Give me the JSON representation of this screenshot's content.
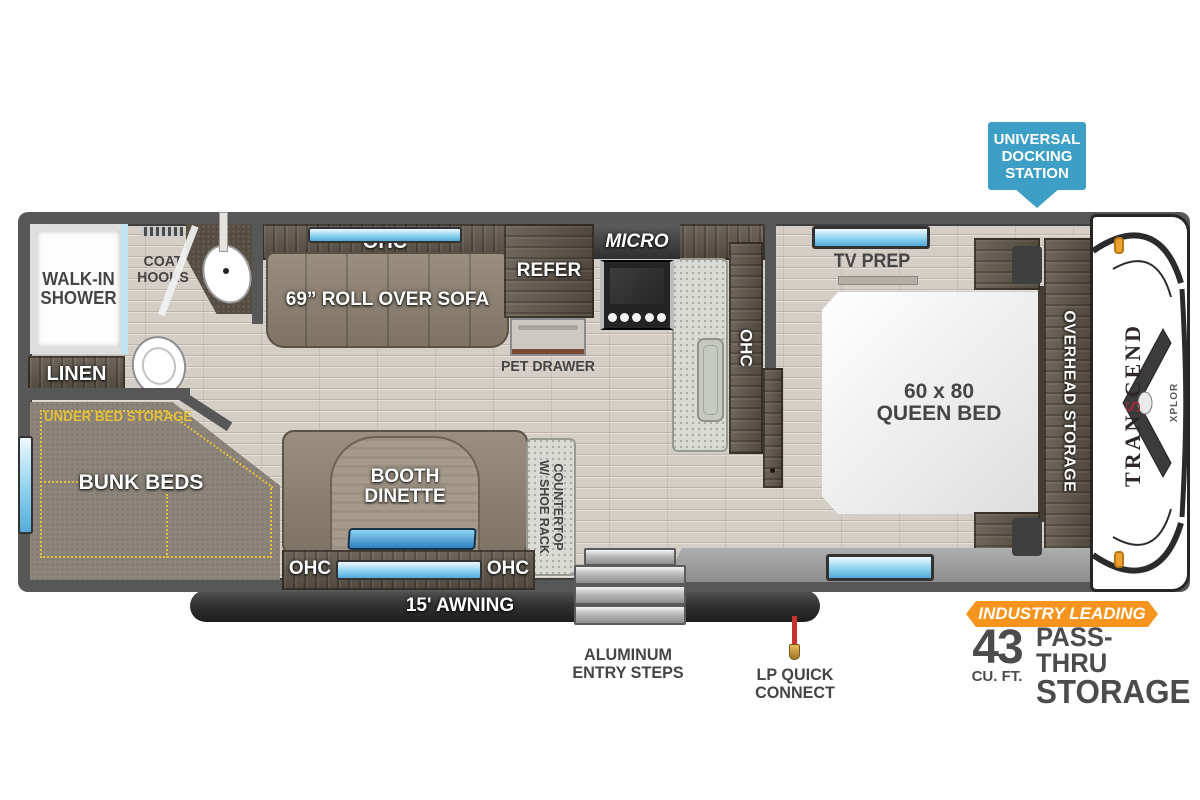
{
  "plan": {
    "labels": {
      "ohc": "OHC",
      "sofa": "69” ROLL OVER SOFA",
      "refer": "REFER",
      "micro": "MICRO",
      "pet_drawer": "PET DRAWER",
      "coat_1": "COAT",
      "coat_2": "HOOKS",
      "shower_1": "WALK-IN",
      "shower_2": "SHOWER",
      "linen": "LINEN",
      "under_bed_storage": "UNDER BED STORAGE",
      "bunk_beds": "BUNK BEDS",
      "dinette_1": "BOOTH",
      "dinette_2": "DINETTE",
      "countertop_1": "COUNTERTOP",
      "countertop_2": "W/ SHOE RACK",
      "tv_prep": "TV PREP",
      "bed_1": "60 x 80",
      "bed_2": "QUEEN BED",
      "overhead_storage": "OVERHEAD STORAGE"
    },
    "exterior": {
      "awning": "15' AWNING",
      "steps_1": "ALUMINUM",
      "steps_2": "ENTRY STEPS",
      "lp_1": "LP QUICK",
      "lp_2": "CONNECT"
    },
    "callouts": {
      "docking_1": "UNIVERSAL",
      "docking_2": "DOCKING",
      "docking_3": "STATION",
      "industry_banner": "INDUSTRY LEADING",
      "industry_number": "43",
      "industry_unit": "CU. FT.",
      "industry_line1": "PASS-THRU",
      "industry_line2": "STORAGE"
    },
    "brand": {
      "t1": "TRAN",
      "t2": "S",
      "t3": "CEND",
      "sub": "XPLOR"
    },
    "colors": {
      "docking_blue": "#3d9fc5",
      "accent_orange": "#f7941e",
      "wall_gray": "#575757",
      "storage_yellow": "#e3c139"
    }
  }
}
